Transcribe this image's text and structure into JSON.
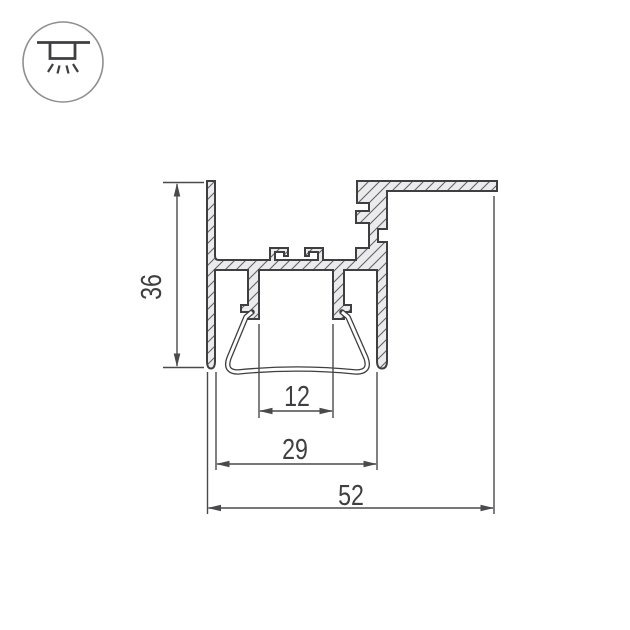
{
  "drawing": {
    "kind": "technical-cross-section",
    "subject": "recessed LED aluminium profile with trapezoid diffuser lens",
    "icon": "recessed-downlight-icon",
    "dimensions": {
      "height": "36",
      "slot_width": "12",
      "opening_width": "29",
      "overall_width": "52"
    }
  },
  "colors": {
    "line": "#3f3f41",
    "dim": "#4a4a4c",
    "fill": "#ebebed",
    "hatch": "#636365",
    "circle": "#8f8f90",
    "background": "#ffffff"
  }
}
